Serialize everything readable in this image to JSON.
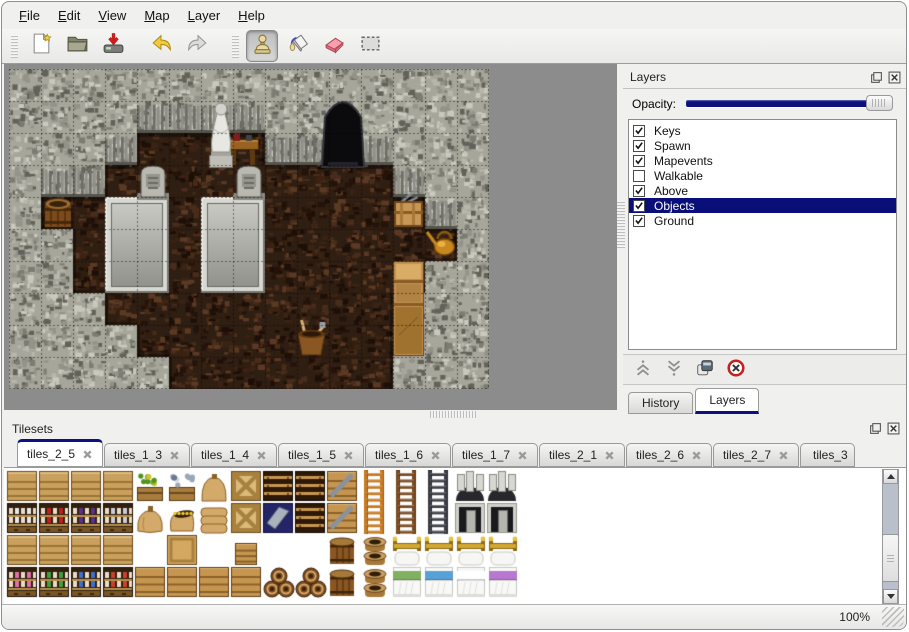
{
  "menubar": {
    "items": [
      {
        "label": "File"
      },
      {
        "label": "Edit"
      },
      {
        "label": "View"
      },
      {
        "label": "Map"
      },
      {
        "label": "Layer"
      },
      {
        "label": "Help"
      }
    ]
  },
  "toolbar": {
    "tools": [
      {
        "name": "new-file"
      },
      {
        "name": "open-file"
      },
      {
        "name": "save-file"
      },
      {
        "name": "undo"
      },
      {
        "name": "redo"
      },
      {
        "name": "stamp-tool",
        "active": true
      },
      {
        "name": "fill-tool"
      },
      {
        "name": "eraser-tool"
      },
      {
        "name": "select-tool"
      }
    ]
  },
  "layers_panel": {
    "title": "Layers",
    "opacity_label": "Opacity:",
    "opacity_value": 100,
    "layers": [
      {
        "name": "Keys",
        "checked": true,
        "selected": false
      },
      {
        "name": "Spawn",
        "checked": true,
        "selected": false
      },
      {
        "name": "Mapevents",
        "checked": true,
        "selected": false
      },
      {
        "name": "Walkable",
        "checked": false,
        "selected": false
      },
      {
        "name": "Above",
        "checked": true,
        "selected": false
      },
      {
        "name": "Objects",
        "checked": true,
        "selected": true
      },
      {
        "name": "Ground",
        "checked": true,
        "selected": false
      }
    ],
    "buttons": [
      "move-layer-up",
      "move-layer-down",
      "duplicate-layer",
      "delete-layer"
    ],
    "tabs": [
      {
        "label": "History",
        "active": false
      },
      {
        "label": "Layers",
        "active": true
      }
    ]
  },
  "tilesets_panel": {
    "title": "Tilesets",
    "tabs": [
      {
        "label": "tiles_2_5",
        "active": true
      },
      {
        "label": "tiles_1_3"
      },
      {
        "label": "tiles_1_4"
      },
      {
        "label": "tiles_1_5"
      },
      {
        "label": "tiles_1_6"
      },
      {
        "label": "tiles_1_7"
      },
      {
        "label": "tiles_2_1"
      },
      {
        "label": "tiles_2_6"
      },
      {
        "label": "tiles_2_7"
      },
      {
        "label": "tiles_3",
        "truncated": true
      }
    ]
  },
  "statusbar": {
    "zoom_level": "100%"
  },
  "colors": {
    "selection_navy": "#0a0e78",
    "tab_accent": "#0d1180",
    "rock": "#a6a69a",
    "floor": "#2f1e12",
    "backdrop": "#8c8c8c"
  },
  "map": {
    "tile_size": 32,
    "cols": 15,
    "rows": 10,
    "grid": [
      "RRRRRRRRRRRRRRR",
      "RRRRRRRRRRRRRRR",
      "RRRRFFFFRRRRRRR",
      "RRRFFFFFFFFFRRR",
      "RFFFFFFFFFFFFRR",
      "RRFFFFFFFFFFFFR",
      "RRFFFFFFFFFFFRR",
      "RRRFFFFFFFFFRRR",
      "RRRRFFFFFFFFRRR",
      "RRRRRFFFFFFFRRR"
    ],
    "objects": [
      {
        "type": "slab",
        "x": 96,
        "y": 128,
        "w": 64,
        "h": 96
      },
      {
        "type": "slab",
        "x": 192,
        "y": 128,
        "w": 64,
        "h": 96
      },
      {
        "type": "tombstone",
        "x": 130,
        "y": 95,
        "w": 28,
        "h": 35
      },
      {
        "type": "tombstone",
        "x": 226,
        "y": 95,
        "w": 28,
        "h": 35
      },
      {
        "type": "table",
        "x": 218,
        "y": 64,
        "w": 32,
        "h": 34
      },
      {
        "type": "statue",
        "x": 196,
        "y": 28,
        "w": 32,
        "h": 72
      },
      {
        "type": "cave",
        "x": 313,
        "y": 28,
        "w": 42,
        "h": 70
      },
      {
        "type": "crate-tools",
        "x": 383,
        "y": 126,
        "w": 33,
        "h": 34
      },
      {
        "type": "watering-can",
        "x": 416,
        "y": 157,
        "w": 33,
        "h": 34
      },
      {
        "type": "shelf",
        "x": 384,
        "y": 192,
        "w": 31,
        "h": 95
      },
      {
        "type": "barrel",
        "x": 34,
        "y": 126,
        "w": 30,
        "h": 34
      },
      {
        "type": "bucket-tools",
        "x": 285,
        "y": 255,
        "w": 35,
        "h": 33
      }
    ]
  },
  "tileset": {
    "tile_size": 32,
    "rows": [
      [
        [
          "shelftop"
        ],
        [
          "shelftop"
        ],
        [
          "shelftop"
        ],
        [
          "shelftop"
        ],
        [
          "plantbox"
        ],
        [
          "icebox"
        ],
        [
          "sacktop"
        ],
        [
          "cratex"
        ],
        [
          "chest"
        ],
        [
          "chest"
        ],
        [
          "cratemetal"
        ],
        [
          "ladder",
          "#c87820"
        ],
        [
          "ladder",
          "#7a4a20"
        ],
        [
          "ladder",
          "#3c3c46"
        ],
        [
          "arch"
        ],
        [
          "arch"
        ],
        []
      ],
      [
        [
          "shelf",
          "#e8e8e8"
        ],
        [
          "shelf",
          "#c02020"
        ],
        [
          "shelf",
          "#5a3090"
        ],
        [
          "shelf",
          "#c8ccd8"
        ],
        [
          "sack"
        ],
        [
          "sackopen"
        ],
        [
          "sackpile"
        ],
        [
          "cratex"
        ],
        [
          "crateblue"
        ],
        [
          "chest"
        ],
        [
          "cratemetal"
        ],
        [
          "ladder",
          "#c87820"
        ],
        [
          "ladder",
          "#7a4a20"
        ],
        [
          "ladder",
          "#3c3c46"
        ],
        [
          "doorway"
        ],
        [
          "doorway"
        ],
        []
      ],
      [
        [
          "shelftop"
        ],
        [
          "shelftop"
        ],
        [
          "shelftop"
        ],
        [
          "shelftop"
        ],
        [],
        [
          "cratetop"
        ],
        [],
        [
          "cratesmall"
        ],
        [],
        [],
        [
          "barrel"
        ],
        [
          "pots"
        ],
        [
          "bedhead"
        ],
        [
          "bedhead"
        ],
        [
          "bedhead"
        ],
        [
          "bedhead"
        ],
        []
      ],
      [
        [
          "shelf",
          "#e070a8"
        ],
        [
          "shelf",
          "#40a040"
        ],
        [
          "shelf",
          "#4070cc"
        ],
        [
          "shelf",
          "#cc4030"
        ],
        [
          "crate"
        ],
        [
          "crate"
        ],
        [
          "crate"
        ],
        [
          "crate"
        ],
        [
          "barrelpile"
        ],
        [
          "barrelpile"
        ],
        [
          "barrel"
        ],
        [
          "pots"
        ],
        [
          "bed",
          "#80b060"
        ],
        [
          "bed",
          "#58a0d8"
        ],
        [
          "bed",
          "#ffffff"
        ],
        [
          "bed",
          "#b878d0"
        ],
        []
      ]
    ]
  }
}
